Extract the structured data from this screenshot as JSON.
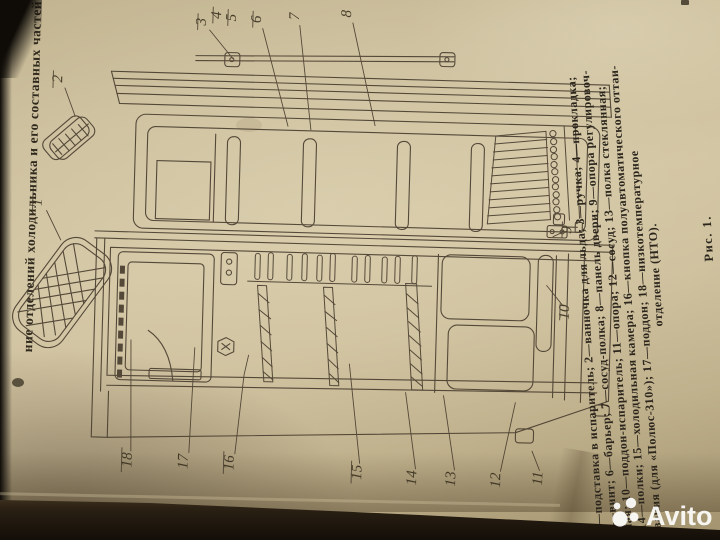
{
  "heading": {
    "text_fragment": "ние отделений холодильника и его составных частей"
  },
  "figure": {
    "label": "Рис. 1.",
    "caption_lines": [
      "1—подставка в испаритель; 2—ванночка для льда; 3—ручка; 4—прокладка;",
      "5—винт; 6—барьер; 7—сосуд-полка; 8—панель двери; 9—опора регулировоч-",
      "ная; 10—поддон-испаритель; 11—опора; 12—сосуд; 13—полка стеклянная;",
      "14—полки; 15—холодильная камера; 16—кнопка полуавтоматического оттаи-",
      "вания (для «Полюс-310»); 17—поддон; 18—низкотемпературное",
      "отделение (НТО)."
    ],
    "part_labels": [
      "1",
      "2",
      "3",
      "4",
      "5",
      "6",
      "7",
      "8",
      "9",
      "10",
      "11",
      "12",
      "13",
      "14",
      "15",
      "16",
      "17",
      "18"
    ]
  },
  "watermark": {
    "brand": "Avito",
    "logo": "avito-circles-logo"
  },
  "colors": {
    "paper": "#d3c6a4",
    "ink": "#43392b",
    "photo_background": "#191510",
    "watermark": "#fdfdfb"
  }
}
